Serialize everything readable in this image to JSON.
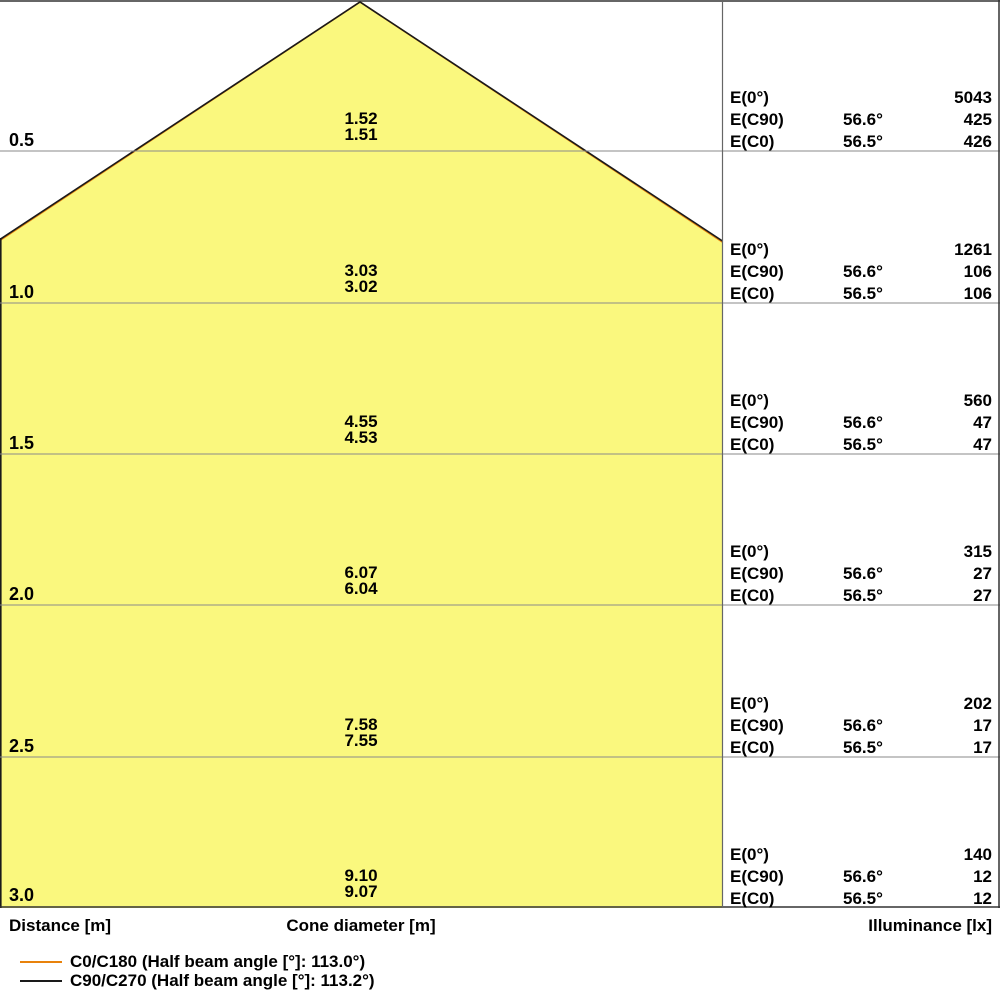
{
  "footer": {
    "distance_label": "Distance [m]",
    "cone_diameter_label": "Cone diameter [m]",
    "illuminance_label": "Illuminance [lx]"
  },
  "legend": {
    "items": [
      {
        "label": "C0/C180 (Half beam angle [°]: 113.0°)",
        "color": "#E8820C"
      },
      {
        "label": "C90/C270 (Half beam angle [°]: 113.2°)",
        "color": "#1A1A1A"
      }
    ]
  },
  "rows": [
    {
      "distance": "0.5",
      "cone_diameters": [
        "1.52",
        "1.51"
      ],
      "e_lines": [
        {
          "label": "E(0°)",
          "angle": "",
          "value": "5043"
        },
        {
          "label": "E(C90)",
          "angle": "56.6°",
          "value": "425"
        },
        {
          "label": "E(C0)",
          "angle": "56.5°",
          "value": "426"
        }
      ]
    },
    {
      "distance": "1.0",
      "cone_diameters": [
        "3.03",
        "3.02"
      ],
      "e_lines": [
        {
          "label": "E(0°)",
          "angle": "",
          "value": "1261"
        },
        {
          "label": "E(C90)",
          "angle": "56.6°",
          "value": "106"
        },
        {
          "label": "E(C0)",
          "angle": "56.5°",
          "value": "106"
        }
      ]
    },
    {
      "distance": "1.5",
      "cone_diameters": [
        "4.55",
        "4.53"
      ],
      "e_lines": [
        {
          "label": "E(0°)",
          "angle": "",
          "value": "560"
        },
        {
          "label": "E(C90)",
          "angle": "56.6°",
          "value": "47"
        },
        {
          "label": "E(C0)",
          "angle": "56.5°",
          "value": "47"
        }
      ]
    },
    {
      "distance": "2.0",
      "cone_diameters": [
        "6.07",
        "6.04"
      ],
      "e_lines": [
        {
          "label": "E(0°)",
          "angle": "",
          "value": "315"
        },
        {
          "label": "E(C90)",
          "angle": "56.6°",
          "value": "27"
        },
        {
          "label": "E(C0)",
          "angle": "56.5°",
          "value": "27"
        }
      ]
    },
    {
      "distance": "2.5",
      "cone_diameters": [
        "7.58",
        "7.55"
      ],
      "e_lines": [
        {
          "label": "E(0°)",
          "angle": "",
          "value": "202"
        },
        {
          "label": "E(C90)",
          "angle": "56.6°",
          "value": "17"
        },
        {
          "label": "E(C0)",
          "angle": "56.5°",
          "value": "17"
        }
      ]
    },
    {
      "distance": "3.0",
      "cone_diameters": [
        "9.10",
        "9.07"
      ],
      "e_lines": [
        {
          "label": "E(0°)",
          "angle": "",
          "value": "140"
        },
        {
          "label": "E(C90)",
          "angle": "56.6°",
          "value": "12"
        },
        {
          "label": "E(C0)",
          "angle": "56.5°",
          "value": "12"
        }
      ]
    }
  ],
  "chart_data": {
    "type": "table",
    "title": "Light cone diagram",
    "axis_labels": {
      "left": "Distance [m]",
      "center": "Cone diameter [m]",
      "right": "Illuminance [lx]"
    },
    "distances_m": [
      0.5,
      1.0,
      1.5,
      2.0,
      2.5,
      3.0
    ],
    "cone_diameter_m": {
      "C90_C270": [
        1.52,
        3.03,
        4.55,
        6.07,
        7.58,
        9.1
      ],
      "C0_C180": [
        1.51,
        3.02,
        4.53,
        6.04,
        7.55,
        9.07
      ]
    },
    "illuminance_lx": {
      "E_0deg": [
        5043,
        1261,
        560,
        315,
        202,
        140
      ],
      "E_C90": [
        425,
        106,
        47,
        27,
        17,
        12
      ],
      "E_C0": [
        426,
        106,
        47,
        27,
        17,
        12
      ]
    },
    "beam_angles_deg": {
      "E_C90_half": 56.6,
      "E_C0_half": 56.5
    },
    "half_beam_angle_full_deg": {
      "C0_C180": 113.0,
      "C90_C270": 113.2
    },
    "legend": [
      "C0/C180 (Half beam angle [°]: 113.0°)",
      "C90/C270 (Half beam angle [°]: 113.2°)"
    ],
    "layout": {
      "grid": true,
      "legend_position": "bottom-left",
      "cone_apex_top_center": true
    },
    "colors": {
      "cone_fill": "#FAF87E",
      "c0_line": "#E8820C",
      "c90_line": "#1A1A1A",
      "gridline": "#8A8A8A",
      "border": "#333333"
    }
  }
}
